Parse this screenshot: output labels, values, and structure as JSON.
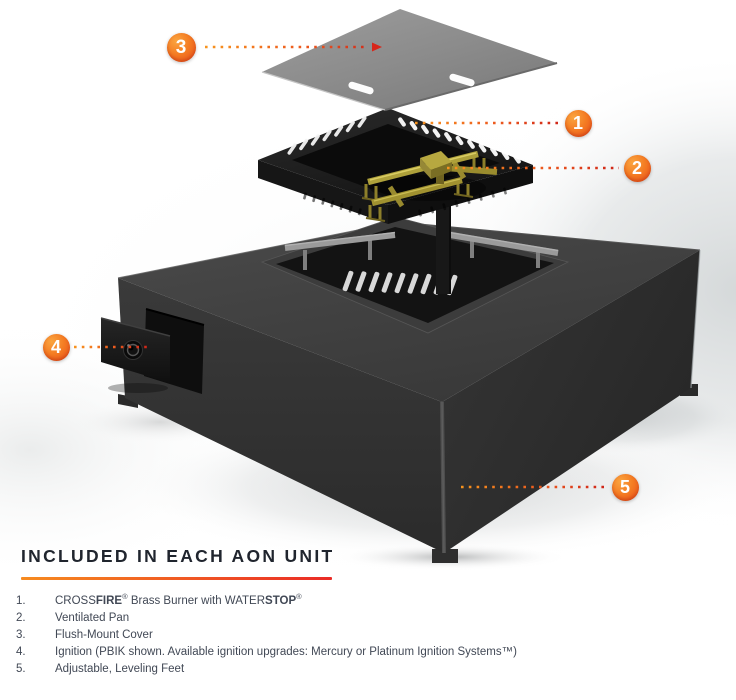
{
  "palette": {
    "accent_orange": "#F58220",
    "accent_red": "#E62E20",
    "callout_text_color": "#FFFFFF"
  },
  "callouts": [
    {
      "number": "1"
    },
    {
      "number": "2"
    },
    {
      "number": "3"
    },
    {
      "number": "4"
    },
    {
      "number": "5"
    }
  ],
  "parts_section": {
    "title": "INCLUDED IN EACH AON UNIT",
    "items": [
      {
        "num": "1.",
        "segments": [
          {
            "text": "CROSS"
          },
          {
            "text": "FIRE",
            "bold": true
          },
          {
            "text": "®",
            "sup": true
          },
          {
            "text": " Brass Burner with WATER"
          },
          {
            "text": "STOP",
            "bold": true
          },
          {
            "text": "®",
            "sup": true
          }
        ]
      },
      {
        "num": "2.",
        "segments": [
          {
            "text": "Ventilated Pan"
          }
        ]
      },
      {
        "num": "3.",
        "segments": [
          {
            "text": "Flush-Mount Cover"
          }
        ]
      },
      {
        "num": "4.",
        "segments": [
          {
            "text": "Ignition (PBIK shown. Available ignition upgrades: Mercury or Platinum Ignition Systems™)"
          }
        ]
      },
      {
        "num": "5.",
        "segments": [
          {
            "text": "Adjustable, Leveling Feet"
          }
        ]
      }
    ]
  }
}
